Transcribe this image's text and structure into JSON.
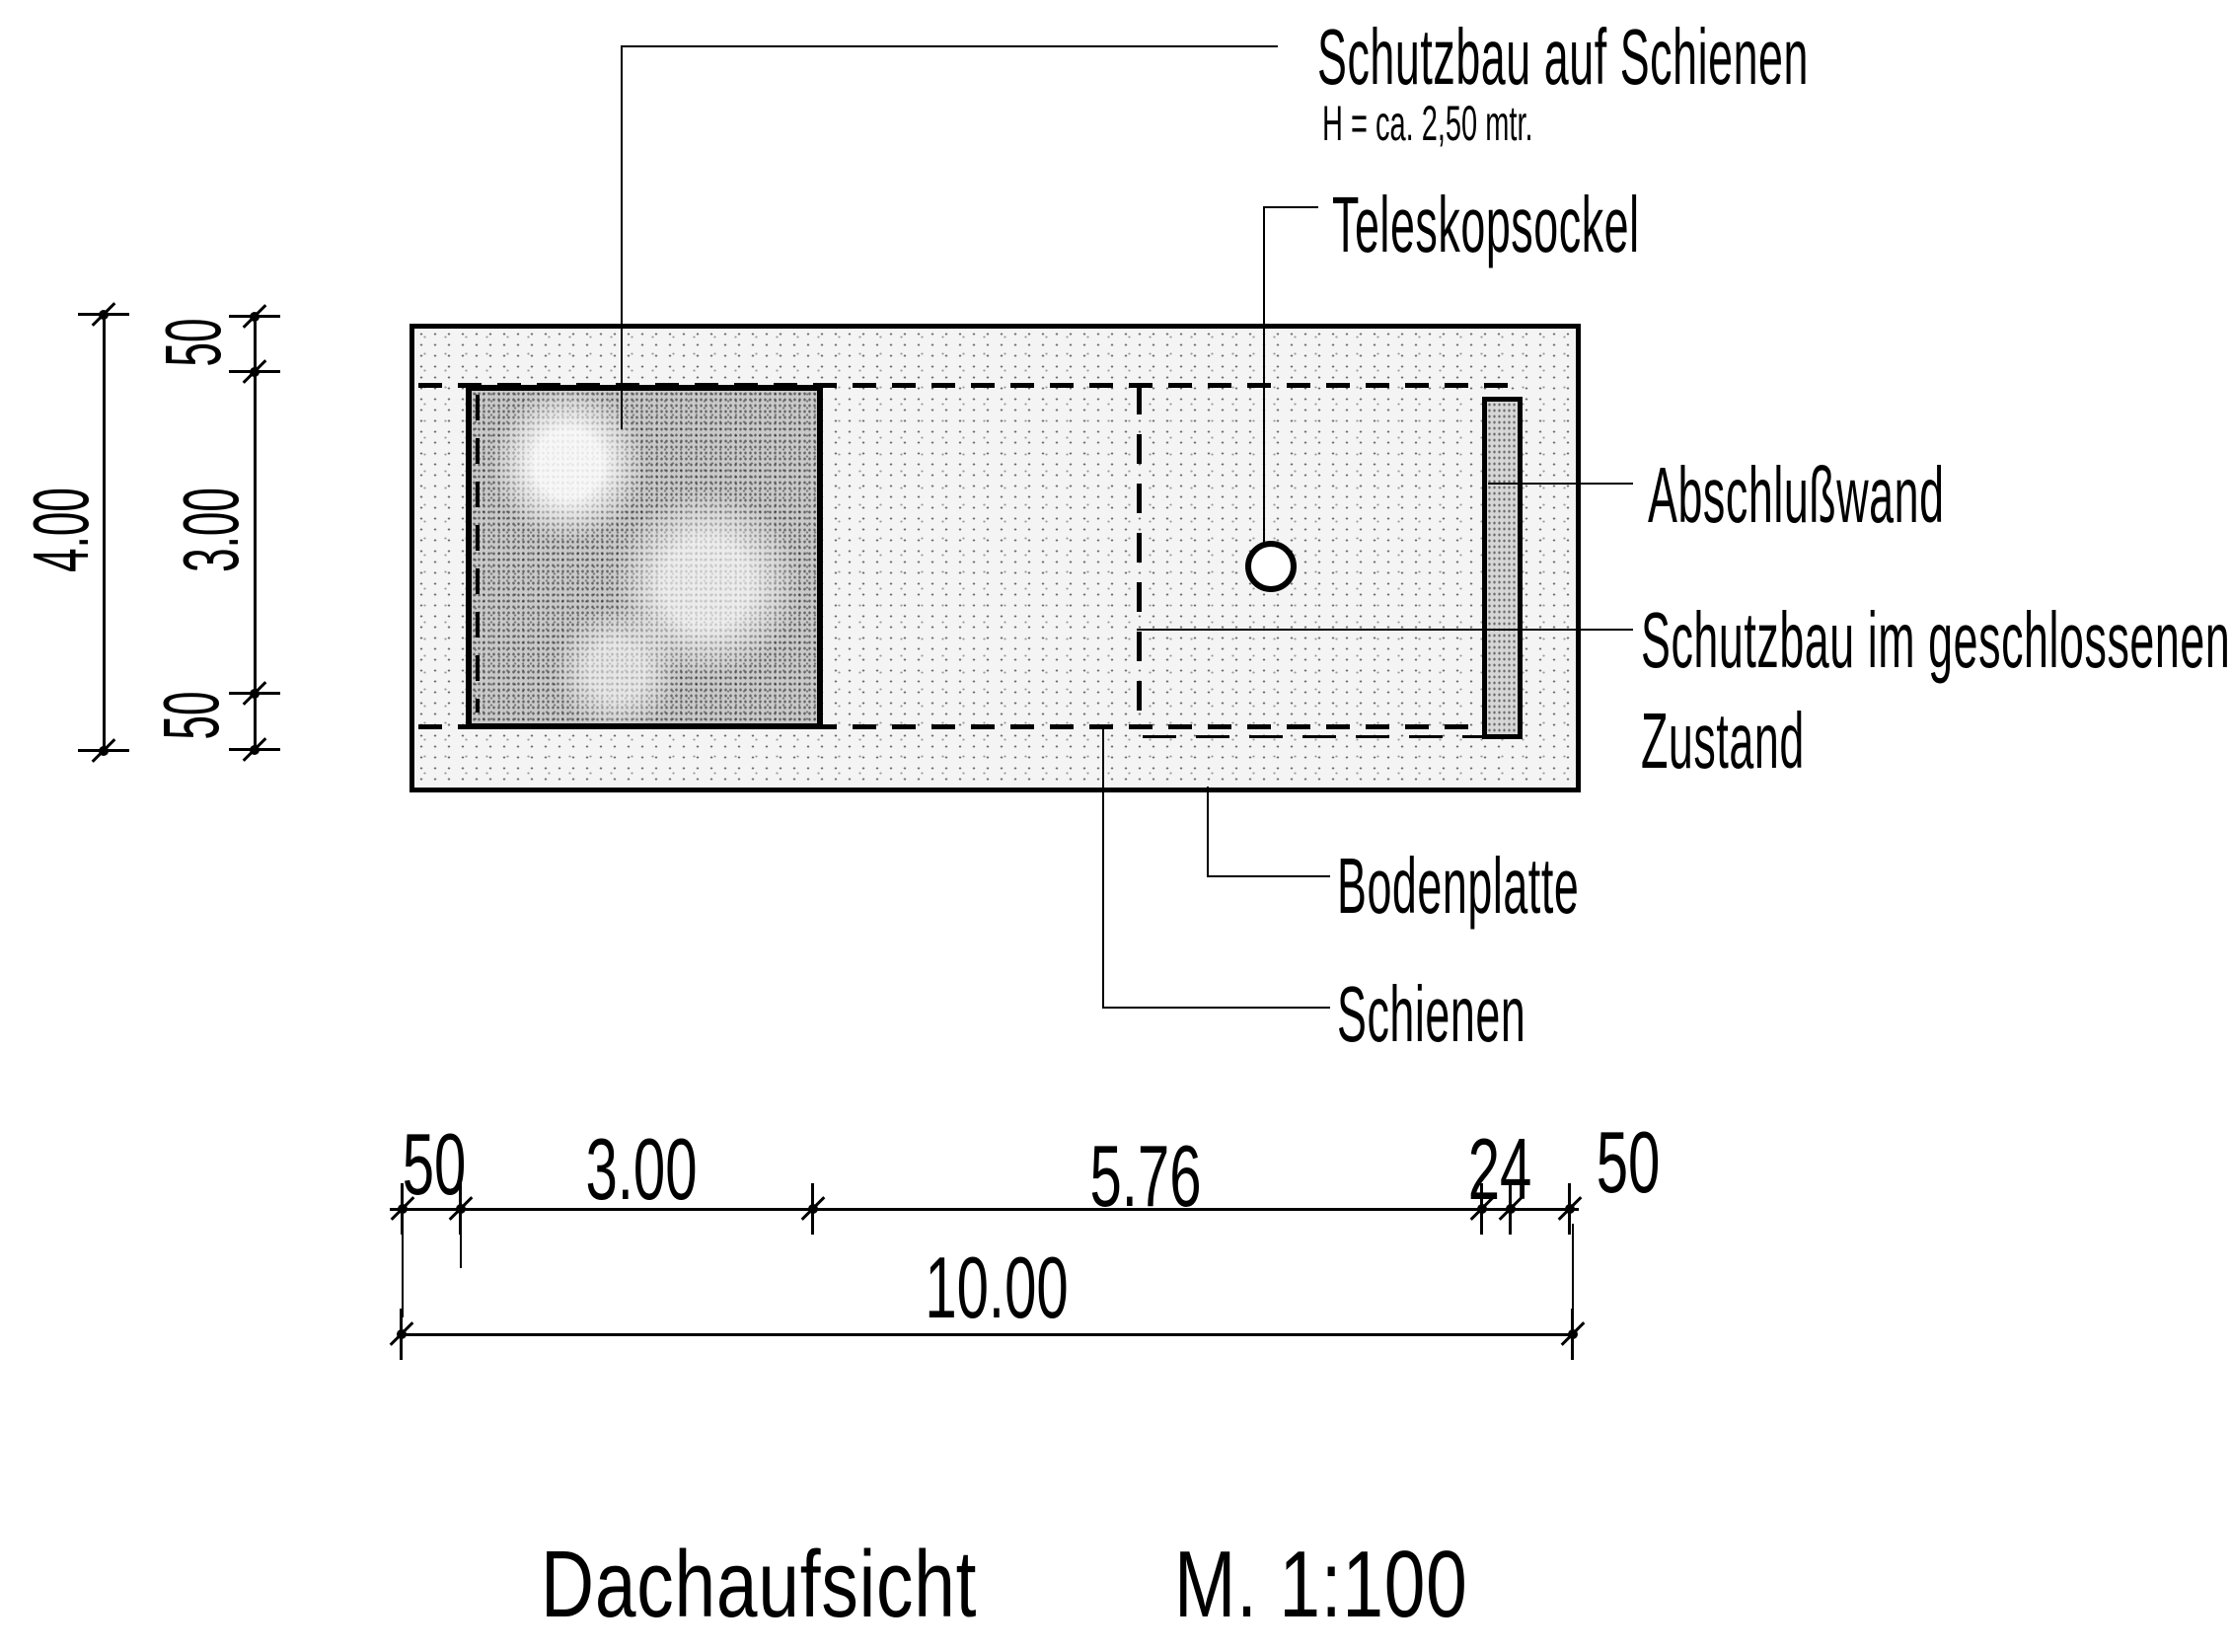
{
  "drawing_title": {
    "label": "Dachaufsicht",
    "scale": "M. 1:100"
  },
  "annotations": {
    "schutzbau_auf_schienen": "Schutzbau auf Schienen",
    "schutzbau_height_note": "H = ca. 2,50 mtr.",
    "teleskopsockel": "Teleskopsockel",
    "abschlusswand": "Abschlußwand",
    "schutzbau_geschlossen": {
      "line1": "Schutzbau im geschlossenen",
      "line2": "Zustand"
    },
    "bodenplatte": "Bodenplatte",
    "schienen": "Schienen"
  },
  "dimensions": {
    "vertical_chain": {
      "total": "4.00",
      "segments": [
        "50",
        "3.00",
        "50"
      ]
    },
    "horizontal_chain": {
      "total": "10.00",
      "segments": [
        "50",
        "3.00",
        "5.76",
        "24",
        "50"
      ]
    }
  },
  "colors": {
    "ink": "#000000",
    "paper": "#ffffff",
    "plate_fill": "#f4f4f4",
    "structure_fill": "#c9c9c9"
  }
}
